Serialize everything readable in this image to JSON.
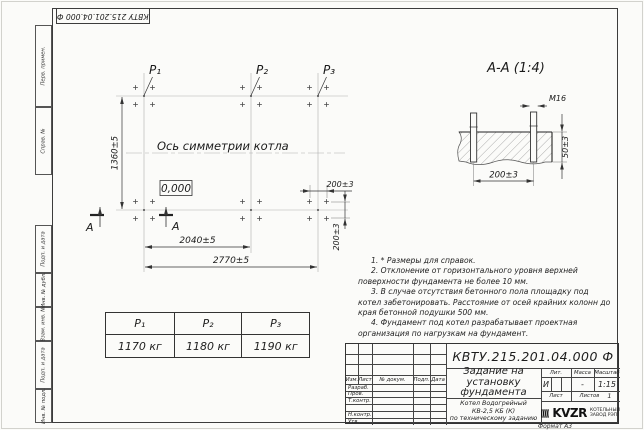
{
  "corner_stamp": {
    "designation": "КВТУ 215.201.04.000 Ф"
  },
  "side_fields": [
    "Перв. примен.",
    "Справ. №",
    "Подп. и дата",
    "Инв. № дубл.",
    "Взам. инв. №",
    "Подп. и дата",
    "Инв. № подл."
  ],
  "plan": {
    "point_labels": [
      "P₁",
      "P₂",
      "P₃"
    ],
    "axis_label": "Ось симметрии котла",
    "elevation_mark": "0,000",
    "dim_height": "1360±5",
    "dim_width_mid": "2040±5",
    "dim_width_total": "2770±5",
    "dim_bolt_x": "200±3",
    "dim_bolt_y": "200±3",
    "section_letter_left": "А",
    "section_letter_right": "А"
  },
  "section_view": {
    "title": "А-А (1:4)",
    "bolt_thread": "М16",
    "dim_embed": "50±3",
    "dim_spacing": "200±3"
  },
  "notes": [
    "1. * Размеры для справок.",
    "2. Отклонение от горизонтального уровня верхней поверхности фундамента не более 10 мм.",
    "3. В случае отсутствия бетонного пола площадку под котел забетонировать. Расстояние от осей крайних колонн до края бетонной подушки 500 мм.",
    "4. Фундамент под котел разрабатывает проектная организация по нагрузкам на фундамент."
  ],
  "load_table": {
    "headers": [
      "P₁",
      "P₂",
      "P₃"
    ],
    "values": [
      "1170 кг",
      "1180 кг",
      "1190 кг"
    ]
  },
  "title_block": {
    "designation": "КВТУ.215.201.04.000 Ф",
    "doc_title": "Задание на\nустановку\nфундамента",
    "product": "Котел Водогрейный\nКВ-2,5 КБ (К)\nпо техническому заданию",
    "col_izm": "Изм.",
    "col_list": "Лист",
    "col_doc": "№ докум.",
    "col_sign": "Подп.",
    "col_date": "Дата",
    "rows": [
      "Разраб.",
      "Пров.",
      "Т.контр.",
      "",
      "Н.контр.",
      "Утв."
    ],
    "lit_label": "Лит.",
    "mass_label": "Масса",
    "scale_label": "Масштаб",
    "lit_value": "И",
    "mass_value": "-",
    "scale_value": "1:15",
    "sheet_label": "Лист",
    "sheets_label": "Листов",
    "sheets_value": "1",
    "company": "KVZR",
    "company_sub": "КОТЕЛЬНЫЙ\nЗАВОД РЭП",
    "format": "Формат А3"
  }
}
